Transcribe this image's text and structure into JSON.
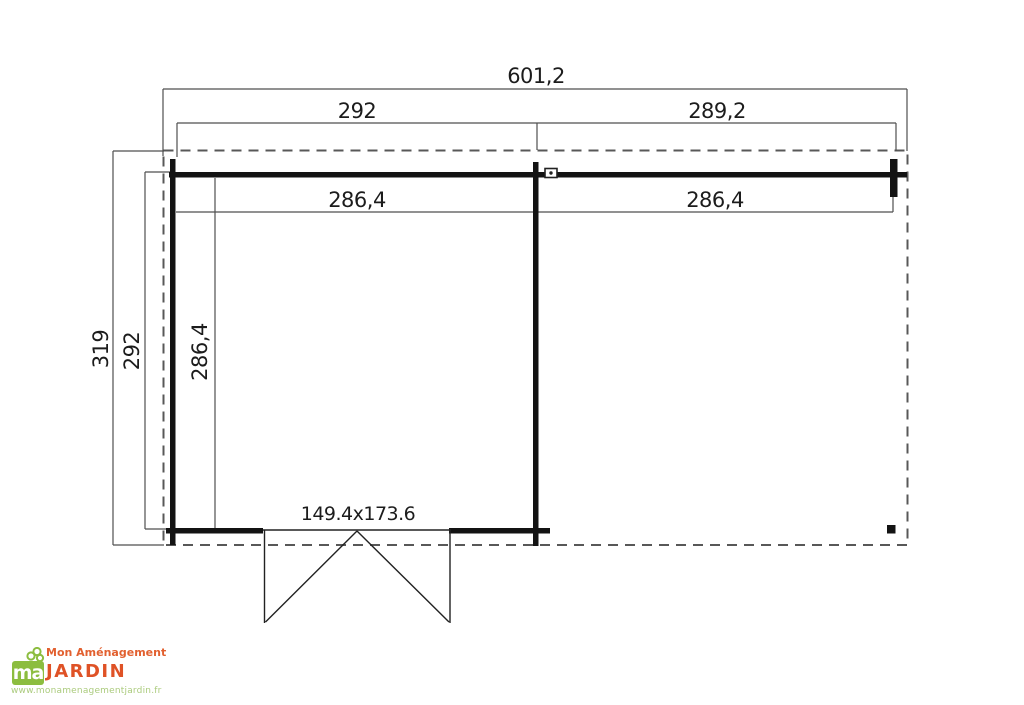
{
  "plan": {
    "type": "garden-cabin-floor-plan",
    "dimensions": {
      "total_width": "601,2",
      "left_section_width": "292",
      "right_section_width": "289,2",
      "left_inner_width": "286,4",
      "right_inner_width": "286,4",
      "total_depth": "319",
      "outer_depth": "292",
      "inner_depth": "286,4",
      "door_size": "149.4x173.6"
    },
    "colors": {
      "wall": "#131313",
      "dimension_line": "#4f4f4f",
      "overhang_dashed": "#585858",
      "background": "#ffffff"
    }
  },
  "logo": {
    "square_text": "ma",
    "tagline": "Mon Aménagement",
    "brand": "JARDIN",
    "website": "www.monamenagementjardin.fr",
    "colors": {
      "orange": "#df5226",
      "green": "#8cbd3f",
      "url_green": "#abcb7d"
    }
  }
}
